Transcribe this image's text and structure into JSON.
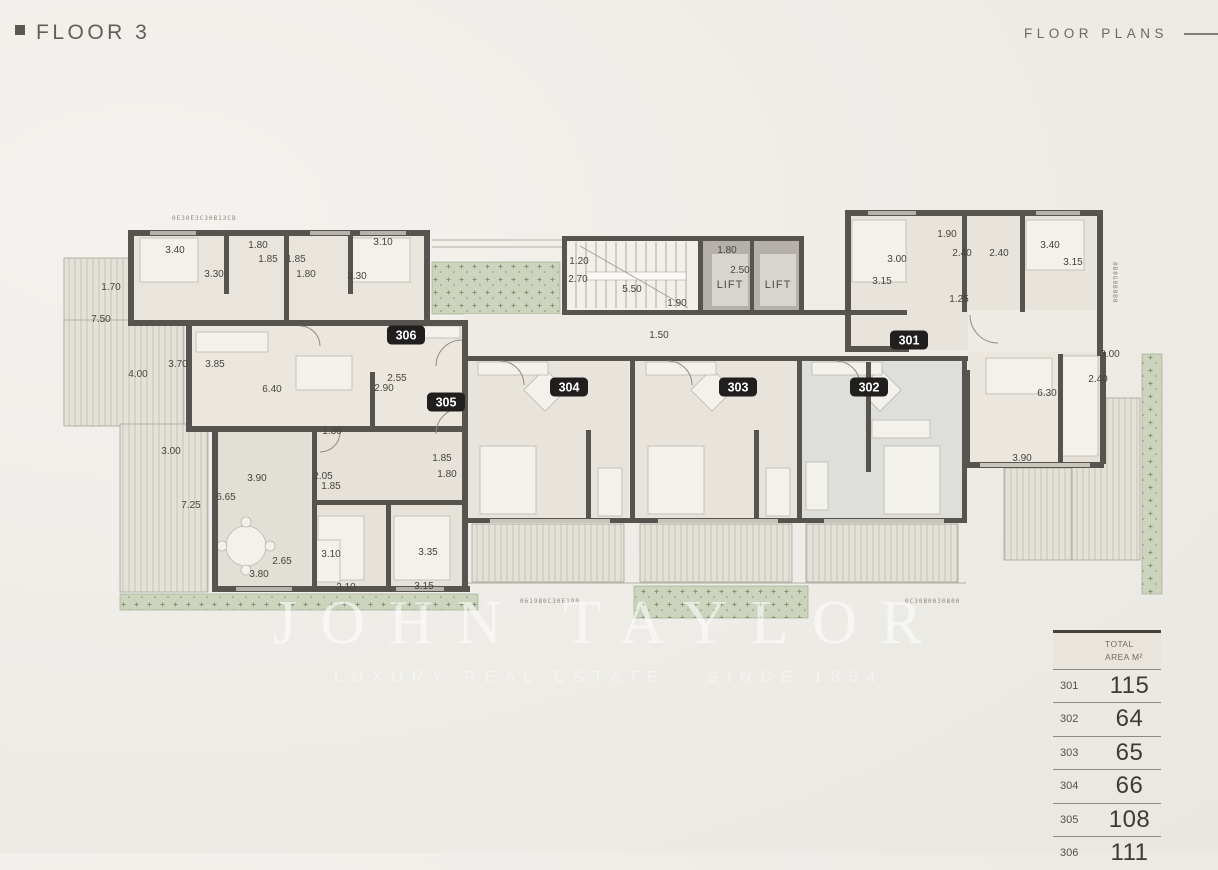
{
  "header": {
    "title": "FLOOR 3",
    "section": "FLOOR PLANS"
  },
  "watermark": {
    "brand": "JOHN TAYLOR",
    "tagline": "LUXURY REAL ESTATE · SINCE 1864"
  },
  "plan": {
    "lift_label": "LIFT",
    "units": [
      {
        "id": "301",
        "x": 909,
        "y": 340
      },
      {
        "id": "302",
        "x": 869,
        "y": 387
      },
      {
        "id": "303",
        "x": 738,
        "y": 387
      },
      {
        "id": "304",
        "x": 569,
        "y": 387
      },
      {
        "id": "305",
        "x": 446,
        "y": 402
      },
      {
        "id": "306",
        "x": 406,
        "y": 335
      }
    ],
    "dimensions": [
      {
        "t": "3.40",
        "x": 175,
        "y": 253
      },
      {
        "t": "1.80",
        "x": 258,
        "y": 248
      },
      {
        "t": "1.85",
        "x": 268,
        "y": 262
      },
      {
        "t": "1.85",
        "x": 296,
        "y": 262
      },
      {
        "t": "3.10",
        "x": 383,
        "y": 245
      },
      {
        "t": "3.30",
        "x": 214,
        "y": 277
      },
      {
        "t": "1.80",
        "x": 306,
        "y": 277
      },
      {
        "t": "3.30",
        "x": 357,
        "y": 279
      },
      {
        "t": "1.70",
        "x": 111,
        "y": 290
      },
      {
        "t": "7.50",
        "x": 101,
        "y": 322
      },
      {
        "t": "4.00",
        "x": 138,
        "y": 377
      },
      {
        "t": "3.70",
        "x": 178,
        "y": 367
      },
      {
        "t": "3.85",
        "x": 215,
        "y": 367
      },
      {
        "t": "6.40",
        "x": 272,
        "y": 392
      },
      {
        "t": "2.55",
        "x": 397,
        "y": 381
      },
      {
        "t": "2.90",
        "x": 384,
        "y": 391
      },
      {
        "t": "3.00",
        "x": 171,
        "y": 454
      },
      {
        "t": "1.30",
        "x": 332,
        "y": 434
      },
      {
        "t": "3.90",
        "x": 257,
        "y": 481
      },
      {
        "t": "2.05",
        "x": 323,
        "y": 479
      },
      {
        "t": "1.85",
        "x": 331,
        "y": 489
      },
      {
        "t": "6.65",
        "x": 226,
        "y": 500
      },
      {
        "t": "7.25",
        "x": 191,
        "y": 508
      },
      {
        "t": "2.65",
        "x": 282,
        "y": 564
      },
      {
        "t": "3.80",
        "x": 259,
        "y": 577
      },
      {
        "t": "3.10",
        "x": 331,
        "y": 557
      },
      {
        "t": "3.35",
        "x": 428,
        "y": 555
      },
      {
        "t": "3.10",
        "x": 346,
        "y": 590
      },
      {
        "t": "3.15",
        "x": 424,
        "y": 589
      },
      {
        "t": "1.85",
        "x": 442,
        "y": 461
      },
      {
        "t": "1.80",
        "x": 447,
        "y": 477
      },
      {
        "t": "1.20",
        "x": 579,
        "y": 264
      },
      {
        "t": "2.70",
        "x": 578,
        "y": 282
      },
      {
        "t": "5.50",
        "x": 632,
        "y": 292
      },
      {
        "t": "1.90",
        "x": 677,
        "y": 306
      },
      {
        "t": "1.80",
        "x": 727,
        "y": 253
      },
      {
        "t": "2.50",
        "x": 740,
        "y": 273
      },
      {
        "t": "1.50",
        "x": 659,
        "y": 338
      },
      {
        "t": "1.90",
        "x": 947,
        "y": 237
      },
      {
        "t": "3.00",
        "x": 897,
        "y": 262
      },
      {
        "t": "2.40",
        "x": 962,
        "y": 256
      },
      {
        "t": "2.40",
        "x": 999,
        "y": 256
      },
      {
        "t": "3.40",
        "x": 1050,
        "y": 248
      },
      {
        "t": "3.15",
        "x": 1073,
        "y": 265
      },
      {
        "t": "3.15",
        "x": 882,
        "y": 284
      },
      {
        "t": "1.25",
        "x": 959,
        "y": 302
      },
      {
        "t": "3.00",
        "x": 1110,
        "y": 357
      },
      {
        "t": "2.40",
        "x": 1098,
        "y": 382
      },
      {
        "t": "6.30",
        "x": 1047,
        "y": 396
      },
      {
        "t": "3.90",
        "x": 1022,
        "y": 461
      }
    ],
    "codes": [
      {
        "t": "0E30E3C30B13CB",
        "x": 172,
        "y": 220,
        "rot": 0
      },
      {
        "t": "0619B0C30E190",
        "x": 520,
        "y": 603,
        "rot": 0
      },
      {
        "t": "0C30B0030B00",
        "x": 905,
        "y": 603,
        "rot": 0
      },
      {
        "t": "0B0G0B0B0",
        "x": 1113,
        "y": 262,
        "rot": 90
      }
    ]
  },
  "area_table": {
    "header_line1": "TOTAL",
    "header_line2": "AREA M²",
    "rows": [
      {
        "unit": "301",
        "area": "115"
      },
      {
        "unit": "302",
        "area": "64"
      },
      {
        "unit": "303",
        "area": "65"
      },
      {
        "unit": "304",
        "area": "66"
      },
      {
        "unit": "305",
        "area": "108"
      },
      {
        "unit": "306",
        "area": "111"
      }
    ]
  },
  "colors": {
    "wall": "#57544f",
    "terrace_green": "#cdd4bd",
    "badge_bg": "#201f1d",
    "paper": "#efede8"
  }
}
